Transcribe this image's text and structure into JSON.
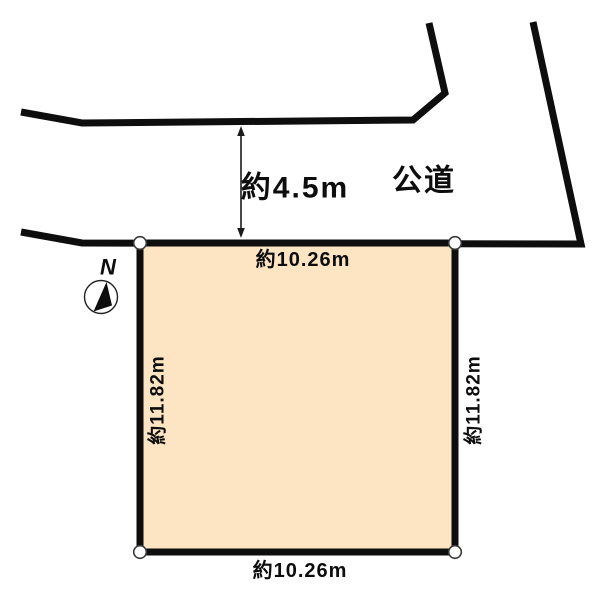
{
  "road": {
    "label": "公道",
    "width_label": "約4.5m"
  },
  "parcel": {
    "top_dimension": "約10.26m",
    "bottom_dimension": "約10.26m",
    "left_dimension": "約11.82m",
    "right_dimension": "約11.82m",
    "fill": "#fde4c3"
  },
  "compass": {
    "north_label": "N"
  },
  "colors": {
    "line": "#0e0e0e",
    "background": "#ffffff",
    "text": "#0d0d0d",
    "corner_marker_fill": "#ffffff"
  }
}
